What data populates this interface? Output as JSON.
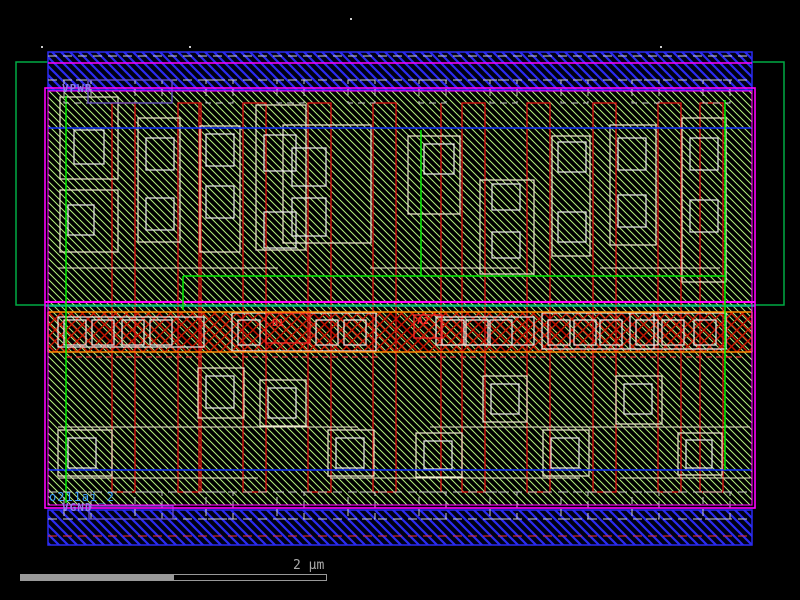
{
  "viewer": {
    "cell_name": "o211ai_2",
    "power_label": "VPWR",
    "ground_label": "VGND",
    "pin_labels": [
      {
        "text": "B1",
        "x": 272,
        "y": 318
      },
      {
        "text": "A2",
        "x": 417,
        "y": 316
      }
    ],
    "scale_bar": {
      "label": "2 µm",
      "filled": {
        "x": 20,
        "y": 574,
        "w": 153,
        "h": 7
      },
      "outline": {
        "x": 173,
        "y": 574,
        "w": 154,
        "h": 7
      },
      "label_x": 293,
      "label_y": 558
    }
  },
  "colors": {
    "background": "#000000",
    "nwell": "#00aa44",
    "hatch_green": "#b4ef7d",
    "rail_blue": "#2b2bf2",
    "rail_bg": "#000014",
    "boundary_magenta": "#ff00ff",
    "teal": "#00b890",
    "implant_blue": "#1133ff",
    "accent_green": "#00ee00",
    "diff_cream": "#f0ead0",
    "poly_red": "#e01010",
    "band_orange": "#ff8800",
    "crosshatch_red": "#c81400",
    "li1_white": "#eeeeee",
    "tab_gray": "#cccccc",
    "pin_red": "#ff2a2a",
    "label_purple": "#6a54cc",
    "red_dash": "#f03030",
    "dot_white": "#cccccc"
  },
  "geometry": {
    "nwell": {
      "x": 16,
      "y": 62,
      "w": 768,
      "h": 243
    },
    "interior": {
      "x": 48,
      "y": 91,
      "w": 704,
      "h": 414
    },
    "mid_band": {
      "x": 48,
      "y": 312,
      "w": 704,
      "h": 40
    },
    "rail_top": {
      "x": 48,
      "y": 52,
      "w": 704,
      "h": 38
    },
    "rail_bottom": {
      "x": 48,
      "y": 510,
      "w": 704,
      "h": 35
    },
    "border_outer": {
      "x": 45,
      "y": 88,
      "w": 710,
      "h": 420
    },
    "border_inner": {
      "x": 48,
      "y": 91,
      "w": 704,
      "h": 414
    },
    "h_lines": [
      {
        "y": 63,
        "x1": 48,
        "x2": 752,
        "color": "boundary_magenta",
        "w": 1.5
      },
      {
        "y": 302,
        "x1": 45,
        "x2": 755,
        "color": "boundary_magenta",
        "w": 2
      },
      {
        "y": 306,
        "x1": 45,
        "x2": 755,
        "color": "teal",
        "w": 1.5
      },
      {
        "y": 128,
        "x1": 48,
        "x2": 752,
        "color": "implant_blue",
        "w": 1.5
      },
      {
        "y": 470,
        "x1": 48,
        "x2": 752,
        "color": "implant_blue",
        "w": 1.5
      },
      {
        "y": 312,
        "x1": 48,
        "x2": 752,
        "color": "band_orange",
        "w": 1.5
      },
      {
        "y": 352,
        "x1": 48,
        "x2": 752,
        "color": "band_orange",
        "w": 1.5
      },
      {
        "y": 276,
        "x1": 183,
        "x2": 725,
        "color": "accent_green",
        "w": 1.5
      }
    ],
    "v_lines": [
      {
        "x": 66,
        "y1": 96,
        "y2": 503,
        "color": "accent_green",
        "w": 1.5
      },
      {
        "x": 421,
        "y1": 130,
        "y2": 276,
        "color": "accent_green",
        "w": 1.5
      },
      {
        "x": 725,
        "y1": 100,
        "y2": 470,
        "color": "accent_green",
        "w": 1.5
      },
      {
        "x": 183,
        "y1": 276,
        "y2": 310,
        "color": "accent_green",
        "w": 1.5
      },
      {
        "x": 48,
        "y1": 312,
        "y2": 352,
        "color": "band_orange",
        "w": 1.5
      },
      {
        "x": 752,
        "y1": 312,
        "y2": 352,
        "color": "band_orange",
        "w": 1.5
      }
    ],
    "dashed_lines": [
      {
        "y": 56,
        "x1": 48,
        "x2": 752,
        "color": "tab_gray"
      },
      {
        "y": 80,
        "x1": 48,
        "x2": 752,
        "color": "tab_gray"
      },
      {
        "y": 492,
        "x1": 48,
        "x2": 752,
        "color": "tab_gray"
      },
      {
        "y": 519,
        "x1": 48,
        "x2": 752,
        "color": "tab_gray"
      },
      {
        "y": 536,
        "x1": 48,
        "x2": 752,
        "color": "red_dash"
      }
    ],
    "tabs": {
      "xs": [
        64,
        135,
        206,
        277,
        348,
        419,
        490,
        561,
        632,
        703
      ],
      "w": 27,
      "top": {
        "y": 80,
        "h": 23
      },
      "bottom": {
        "y": 492,
        "h": 27
      }
    },
    "label_boxes": [
      {
        "x": 88,
        "y": 80,
        "w": 84,
        "h": 23
      },
      {
        "x": 89,
        "y": 506,
        "w": 84,
        "h": 13
      }
    ],
    "poly_strips": {
      "xs": [
        112,
        178,
        243,
        308,
        373,
        462,
        527,
        593,
        658,
        700
      ],
      "w": 23,
      "y": 103,
      "h": 389
    },
    "poly_lines": [
      {
        "x": 199,
        "y1": 103,
        "y2": 492
      },
      {
        "x": 441,
        "y1": 103,
        "y2": 492
      }
    ],
    "diff_upper": [
      [
        60,
        97,
        58,
        82
      ],
      [
        60,
        190,
        58,
        62
      ],
      [
        138,
        118,
        42,
        124
      ],
      [
        200,
        126,
        40,
        126
      ],
      [
        256,
        105,
        50,
        145
      ],
      [
        283,
        125,
        88,
        118
      ],
      [
        408,
        136,
        52,
        78
      ],
      [
        480,
        180,
        54,
        94
      ],
      [
        552,
        136,
        38,
        120
      ],
      [
        610,
        125,
        46,
        120
      ],
      [
        682,
        118,
        44,
        164
      ]
    ],
    "contacts_upper": [
      [
        74,
        130,
        30,
        34
      ],
      [
        68,
        205,
        26,
        30
      ],
      [
        146,
        138,
        28,
        32
      ],
      [
        146,
        198,
        28,
        32
      ],
      [
        206,
        134,
        28,
        32
      ],
      [
        206,
        186,
        28,
        32
      ],
      [
        264,
        135,
        32,
        36
      ],
      [
        264,
        212,
        32,
        36
      ],
      [
        292,
        148,
        34,
        38
      ],
      [
        292,
        198,
        34,
        38
      ],
      [
        424,
        144,
        30,
        30
      ],
      [
        492,
        184,
        28,
        26
      ],
      [
        492,
        232,
        28,
        26
      ],
      [
        558,
        142,
        28,
        30
      ],
      [
        558,
        212,
        28,
        30
      ],
      [
        618,
        138,
        28,
        32
      ],
      [
        618,
        195,
        28,
        32
      ],
      [
        690,
        138,
        28,
        32
      ],
      [
        690,
        200,
        28,
        32
      ]
    ],
    "diff_lower": [
      [
        58,
        430,
        54,
        46
      ],
      [
        198,
        368,
        46,
        50
      ],
      [
        260,
        380,
        46,
        46
      ],
      [
        328,
        430,
        46,
        46
      ],
      [
        416,
        433,
        46,
        44
      ],
      [
        483,
        376,
        44,
        46
      ],
      [
        543,
        430,
        46,
        46
      ],
      [
        616,
        376,
        46,
        48
      ],
      [
        678,
        433,
        44,
        42
      ]
    ],
    "contacts_lower": [
      [
        68,
        438,
        28,
        30
      ],
      [
        206,
        376,
        28,
        32
      ],
      [
        268,
        388,
        28,
        30
      ],
      [
        336,
        438,
        28,
        30
      ],
      [
        424,
        441,
        28,
        28
      ],
      [
        491,
        384,
        28,
        30
      ],
      [
        551,
        438,
        28,
        30
      ],
      [
        624,
        384,
        28,
        30
      ],
      [
        686,
        440,
        26,
        28
      ]
    ],
    "diff_segments": [
      [
        58,
        268,
        220
      ],
      [
        370,
        268,
        150
      ],
      [
        600,
        268,
        120
      ],
      [
        58,
        427,
        300
      ],
      [
        430,
        427,
        320
      ],
      [
        58,
        478,
        200
      ],
      [
        330,
        478,
        250
      ],
      [
        620,
        478,
        130
      ]
    ],
    "mid_outlines": [
      [
        58,
        317,
        146,
        30
      ],
      [
        232,
        313,
        144,
        38
      ],
      [
        436,
        317,
        98,
        28
      ],
      [
        542,
        313,
        112,
        36
      ],
      [
        630,
        313,
        96,
        36
      ]
    ],
    "mid_squares": {
      "xs": [
        64,
        92,
        122,
        150,
        238,
        316,
        344,
        442,
        466,
        490,
        548,
        574,
        600,
        636,
        662,
        694
      ],
      "y": 320,
      "w": 22,
      "h": 25
    },
    "pin_boxes": [
      [
        266,
        313,
        44,
        30
      ],
      [
        414,
        315,
        28,
        23
      ]
    ],
    "red_dashes": [
      [
        66,
        357,
        140
      ],
      [
        232,
        357,
        150
      ],
      [
        420,
        357,
        130
      ],
      [
        560,
        357,
        120
      ],
      [
        686,
        357,
        60
      ]
    ],
    "dots": [
      [
        350,
        18
      ],
      [
        41,
        46
      ],
      [
        189,
        46
      ],
      [
        660,
        46
      ]
    ]
  }
}
